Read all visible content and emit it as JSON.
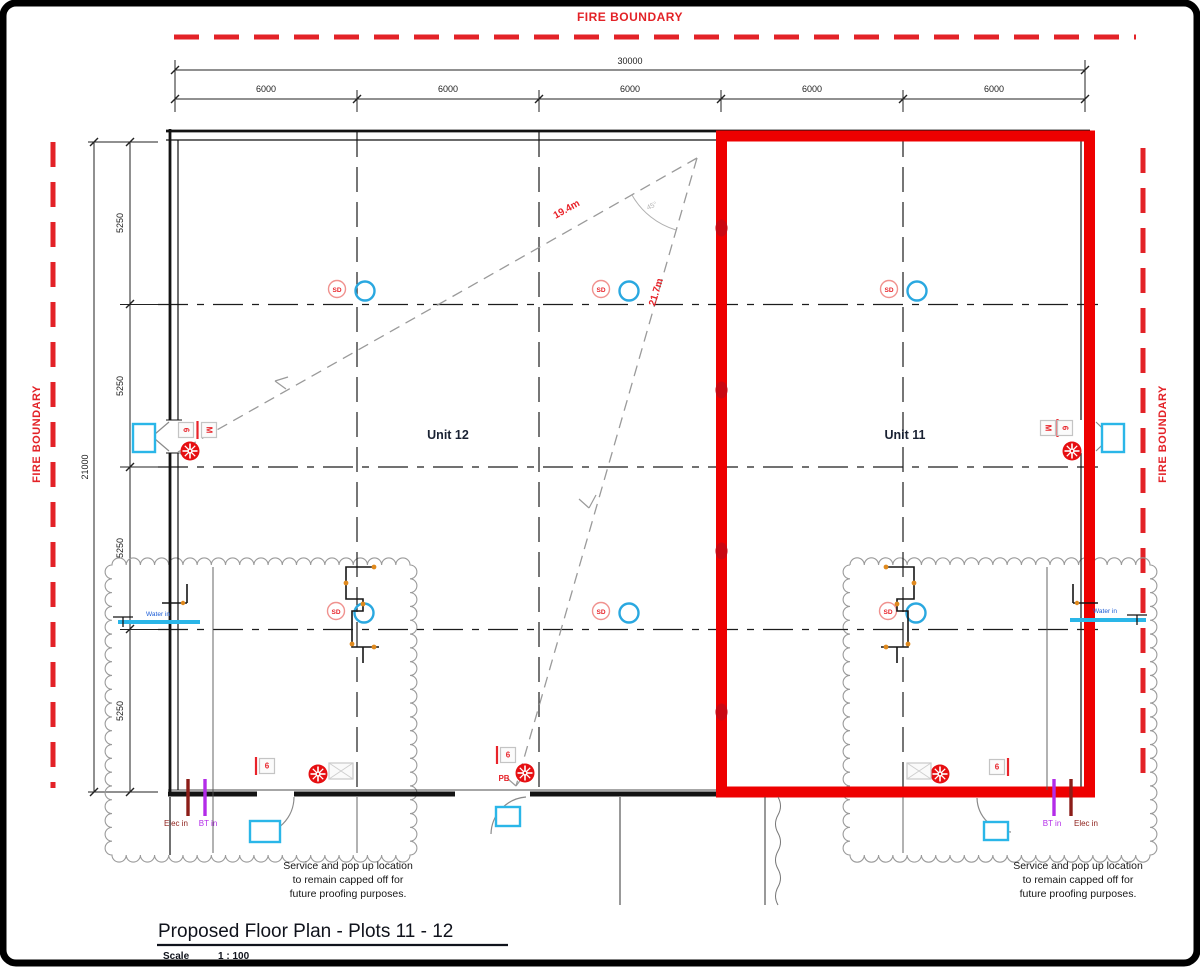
{
  "fire_boundary": {
    "label": "FIRE BOUNDARY",
    "color": "#e32227"
  },
  "dims": {
    "overall_width": "30000",
    "bays_x": [
      "6000",
      "6000",
      "6000",
      "6000",
      "6000"
    ],
    "overall_height": "21000",
    "bays_y": [
      "5250",
      "5250",
      "5250",
      "5250"
    ]
  },
  "units": {
    "unit12": "Unit 12",
    "unit11": "Unit 11",
    "outline_color": "#ee0000"
  },
  "diagonals": {
    "d1": "19.4m",
    "d2": "21.7m",
    "angle": "45°"
  },
  "symbols": {
    "smoke_detector": "SD",
    "push_button": "PB",
    "box_m": "M",
    "box_6": "6",
    "detector_ring_color": "#2aa8e0",
    "sounder_color": "#e60f12",
    "cyan_fitting_color": "#2ab6e8"
  },
  "services": {
    "elec": "Elec in",
    "bt": "BT in",
    "water": "Water in",
    "elec_color": "#8c1d18",
    "bt_color": "#b32ce8",
    "note": [
      "Service and pop up location",
      "to remain capped off for",
      "future proofing purposes."
    ]
  },
  "title_block": {
    "title": "Proposed Floor Plan - Plots 11 - 12",
    "scale_label": "Scale",
    "scale_value": "1 : 100"
  }
}
